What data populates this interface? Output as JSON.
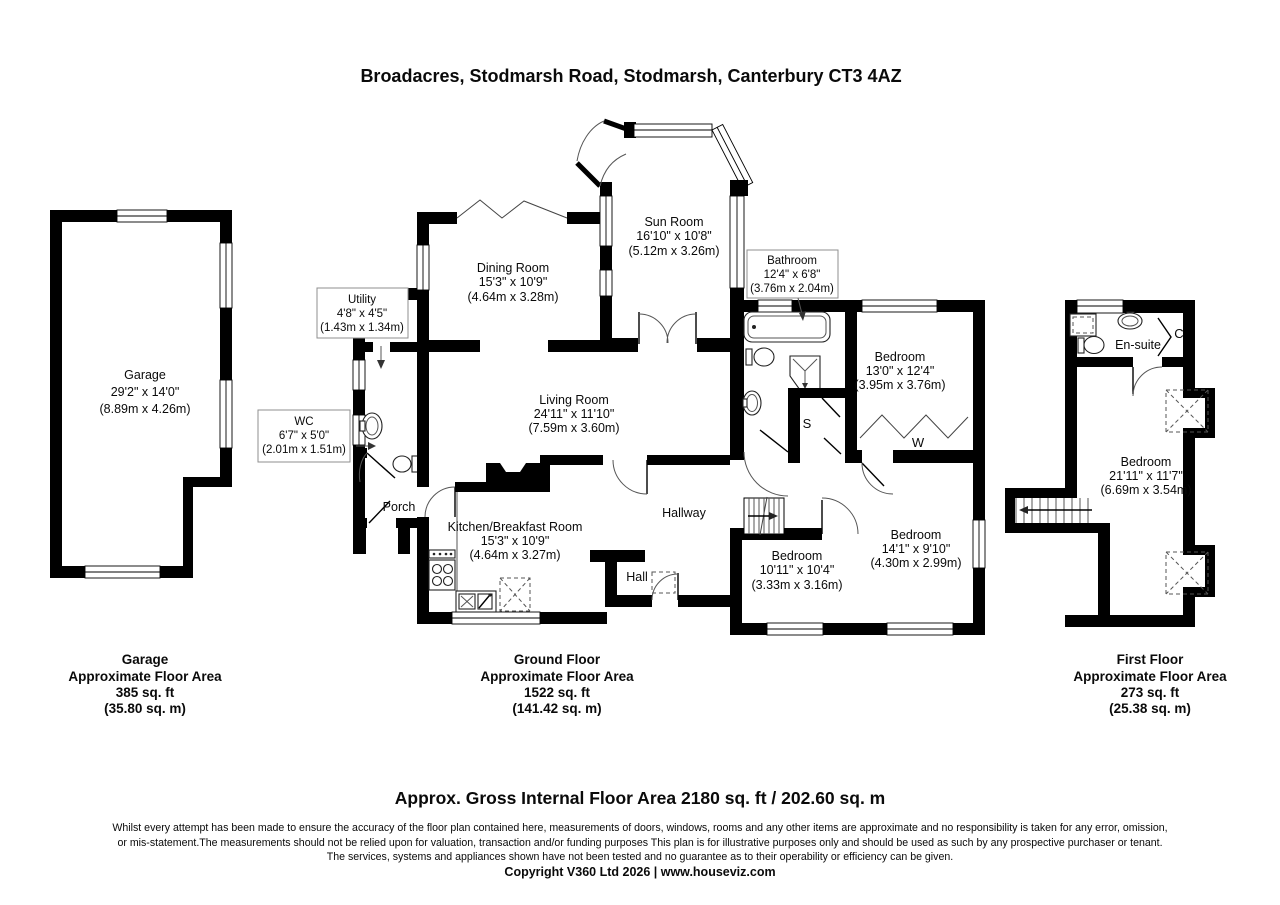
{
  "title": "Broadacres, Stodmarsh Road, Stodmarsh, Canterbury CT3 4AZ",
  "rooms": {
    "garage": {
      "name": "Garage",
      "dims_ft": "29'2\" x 14'0\"",
      "dims_m": "(8.89m x 4.26m)"
    },
    "utility": {
      "name": "Utility",
      "dims_ft": "4'8\" x 4'5\"",
      "dims_m": "(1.43m x 1.34m)"
    },
    "wc": {
      "name": "WC",
      "dims_ft": "6'7\" x 5'0\"",
      "dims_m": "(2.01m x 1.51m)"
    },
    "porch": {
      "name": "Porch"
    },
    "dining_room": {
      "name": "Dining Room",
      "dims_ft": "15'3\" x 10'9\"",
      "dims_m": "(4.64m x 3.28m)"
    },
    "sun_room": {
      "name": "Sun Room",
      "dims_ft": "16'10\" x 10'8\"",
      "dims_m": "(5.12m x 3.26m)"
    },
    "living_room": {
      "name": "Living Room",
      "dims_ft": "24'11\" x 11'10\"",
      "dims_m": "(7.59m x 3.60m)"
    },
    "kitchen": {
      "name": "Kitchen/Breakfast Room",
      "dims_ft": "15'3\" x 10'9\"",
      "dims_m": "(4.64m x 3.27m)"
    },
    "hallway": {
      "name": "Hallway"
    },
    "hall": {
      "name": "Hall"
    },
    "bathroom": {
      "name": "Bathroom",
      "dims_ft": "12'4\" x 6'8\"",
      "dims_m": "(3.76m x 2.04m)"
    },
    "bedroom1": {
      "name": "Bedroom",
      "dims_ft": "13'0\" x 12'4\"",
      "dims_m": "(3.95m x 3.76m)"
    },
    "bedroom2": {
      "name": "Bedroom",
      "dims_ft": "10'11\" x 10'4\"",
      "dims_m": "(3.33m x 3.16m)"
    },
    "bedroom3": {
      "name": "Bedroom",
      "dims_ft": "14'1\" x 9'10\"",
      "dims_m": "(4.30m x 2.99m)"
    },
    "first_bedroom": {
      "name": "Bedroom",
      "dims_ft": "21'11\" x 11'7\"",
      "dims_m": "(6.69m x 3.54m)"
    },
    "ensuite": {
      "name": "En-suite"
    },
    "store": {
      "label": "S"
    },
    "wardrobe": {
      "label": "W"
    },
    "cupboard": {
      "label": "C"
    }
  },
  "floor_summaries": {
    "garage": {
      "floor": "Garage",
      "subtitle": "Approximate Floor Area",
      "area_ft": "385 sq. ft",
      "area_m": "(35.80 sq. m)"
    },
    "ground": {
      "floor": "Ground Floor",
      "subtitle": "Approximate Floor Area",
      "area_ft": "1522 sq. ft",
      "area_m": "(141.42 sq. m)"
    },
    "first": {
      "floor": "First Floor",
      "subtitle": "Approximate Floor Area",
      "area_ft": "273 sq. ft",
      "area_m": "(25.38 sq. m)"
    }
  },
  "footer": {
    "gross_area": "Approx. Gross Internal Floor Area 2180 sq. ft / 202.60 sq. m",
    "disclaimer_1": "Whilst every attempt has been made to ensure the accuracy of the floor plan contained here, measurements of doors, windows, rooms and any other items are approximate and no responsibility is taken for any error, omission,",
    "disclaimer_2": "or mis-statement.The measurements should not be relied upon for valuation, transaction and/or funding purposes This plan is for illustrative purposes only and should be used as such by any prospective purchaser or tenant.",
    "disclaimer_3": "The services, systems and appliances shown have not been tested and no guarantee as to their operability or efficiency can be given.",
    "copyright": "Copyright V360 Ltd 2026 | www.houseviz.com"
  },
  "colors": {
    "wall": "#000000",
    "label_box_border": "#8f8f8f",
    "background": "#ffffff"
  }
}
